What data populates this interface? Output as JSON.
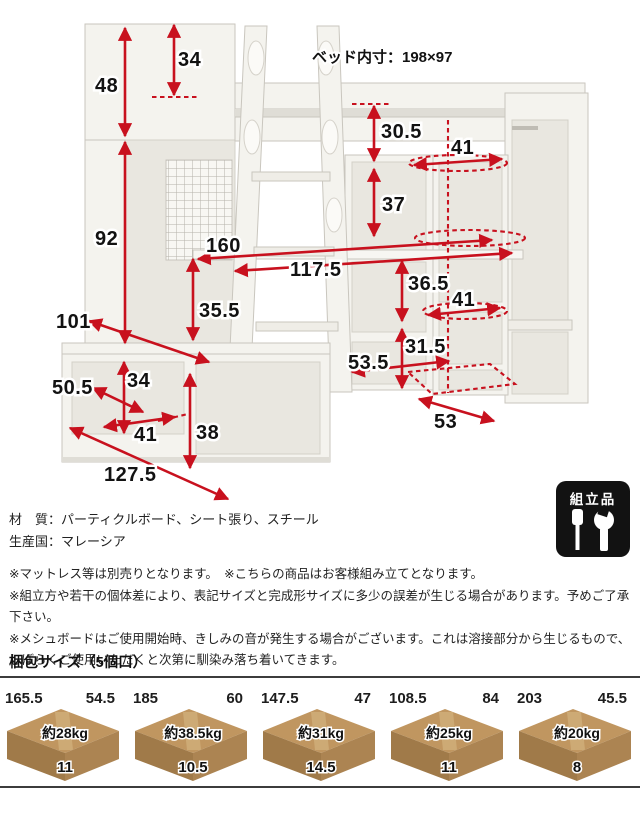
{
  "diagram": {
    "bed_inner_label": "ベッド内寸：198×97",
    "dims": {
      "h48": "48",
      "h34_top": "34",
      "h92": "92",
      "h30_5": "30.5",
      "w41_top": "41",
      "h37": "37",
      "w160": "160",
      "w117_5": "117.5",
      "h35_5": "35.5",
      "h36_5": "36.5",
      "w41_mid": "41",
      "h31_5": "31.5",
      "d53_5": "53.5",
      "d53": "53",
      "d101": "101",
      "d50_5": "50.5",
      "h34_btm": "34",
      "w41_btm": "41",
      "h38": "38",
      "d127_5": "127.5"
    }
  },
  "badge": {
    "label": "組立品"
  },
  "info": {
    "material": "材　質：パーティクルボード、シート張り、スチール",
    "origin": "生産国：マレーシア",
    "note1": "※マットレス等は別売りとなります。　※こちらの商品はお客様組み立てとなります。",
    "note2": "※組立方や若干の個体差により、表記サイズと完成形サイズに多少の誤差が生じる場合があります。予めご了承下さい。",
    "note3": "※メシュボードはご使用開始時、きしみの音が発生する場合がございます。これは溶接部分から生じるもので、",
    "note4": "しばらくご使用いただくと次第に馴染み落ち着いてきます。"
  },
  "packing": {
    "title": "梱包サイズ（5個口）",
    "boxes": [
      {
        "length": "165.5",
        "depth": "54.5",
        "weight": "約28kg",
        "height": "11"
      },
      {
        "length": "185",
        "depth": "60",
        "weight": "約38.5kg",
        "height": "10.5"
      },
      {
        "length": "147.5",
        "depth": "47",
        "weight": "約31kg",
        "height": "14.5"
      },
      {
        "length": "108.5",
        "depth": "84",
        "weight": "約25kg",
        "height": "11"
      },
      {
        "length": "203",
        "depth": "45.5",
        "weight": "約20kg",
        "height": "8"
      }
    ]
  },
  "colors": {
    "accent_red": "#c8111e",
    "box_top": "#c09660",
    "box_front": "#a07a49",
    "box_side": "#ac8452",
    "badge_bg": "#121212"
  }
}
